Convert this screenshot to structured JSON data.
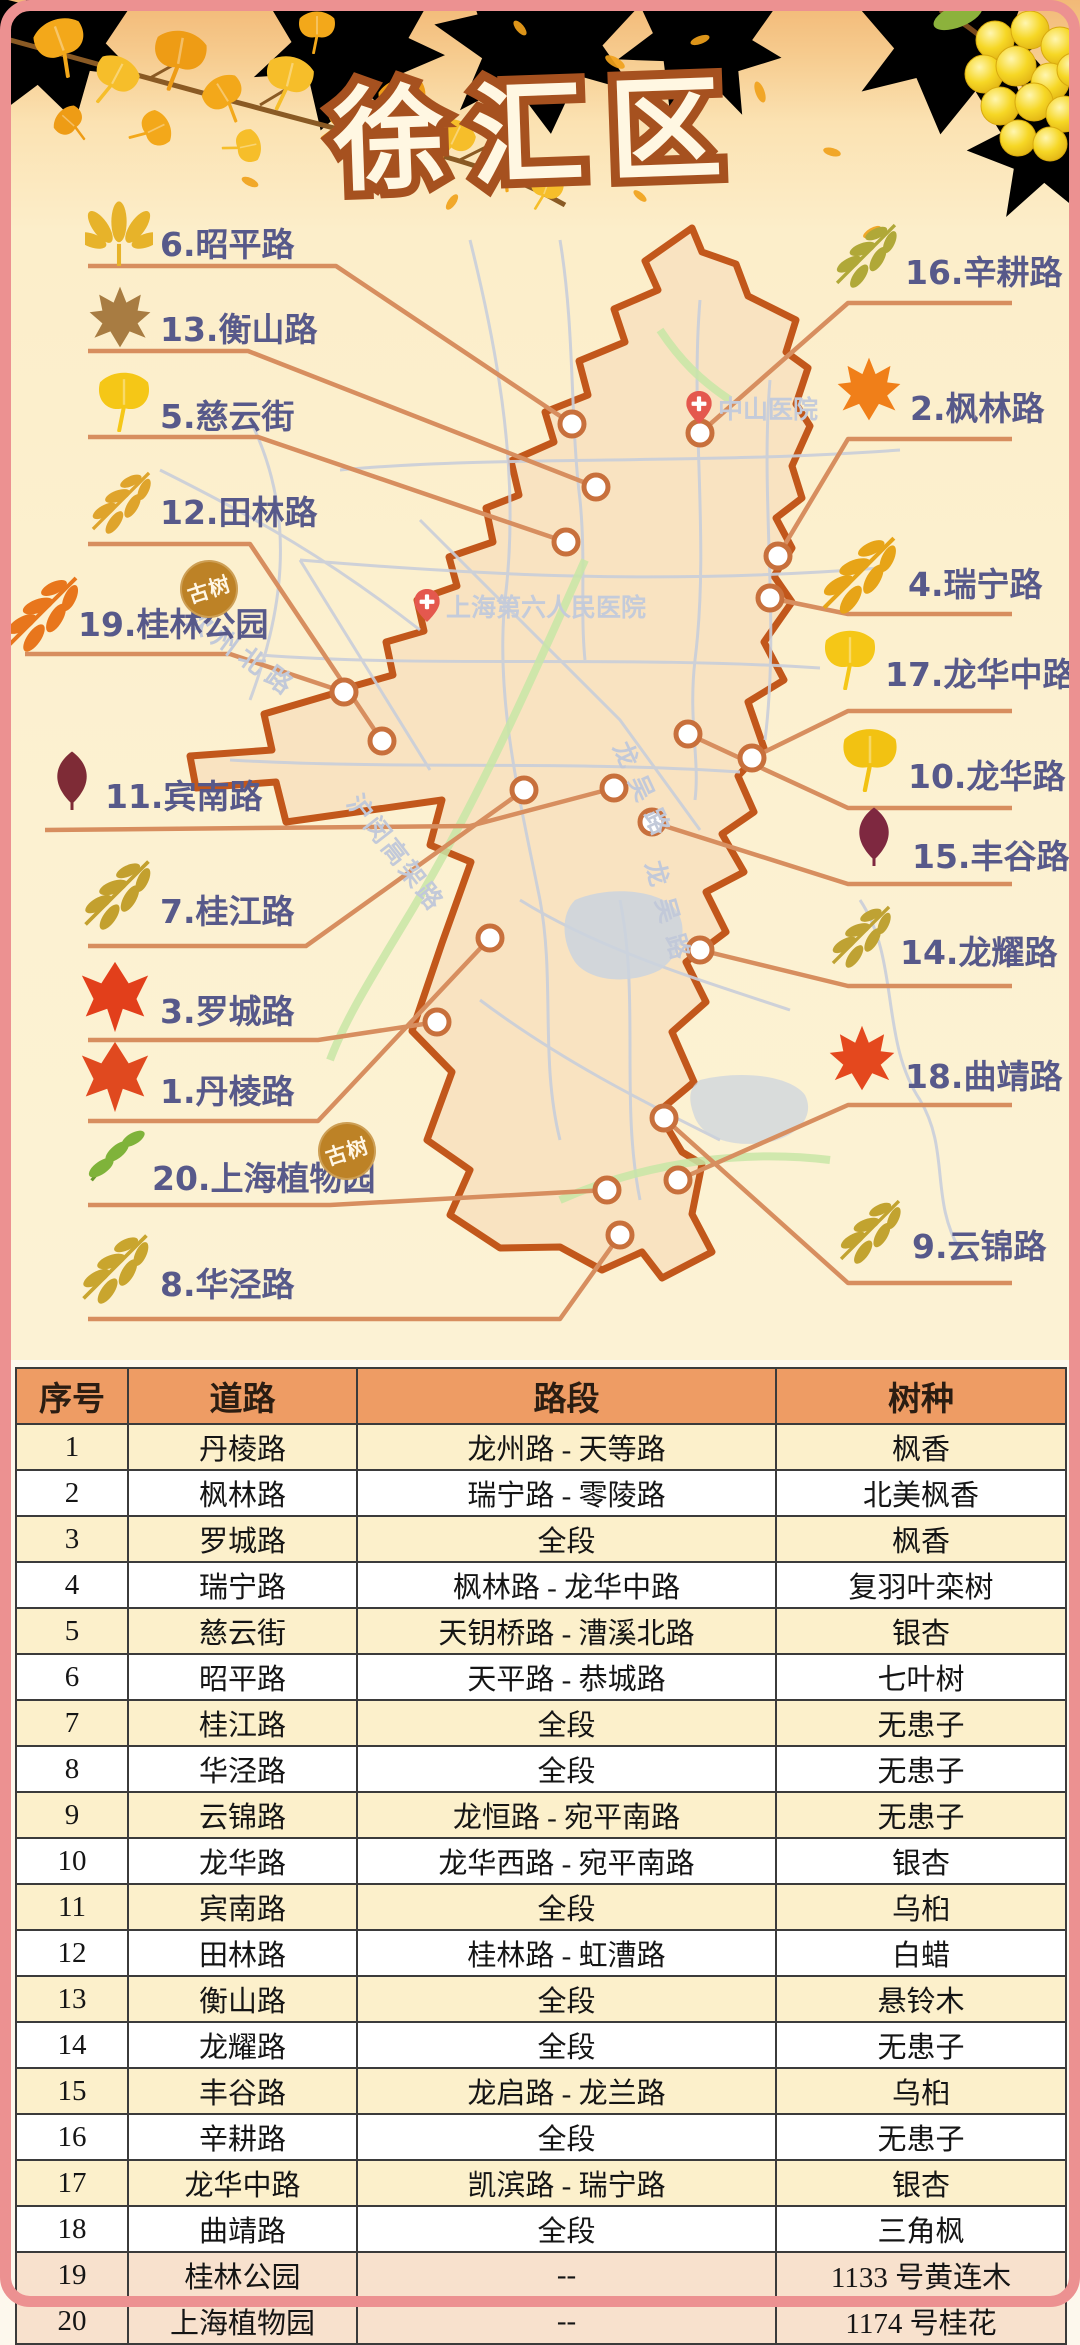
{
  "title": "徐汇区",
  "badge": "古树",
  "map": {
    "hospitals": [
      {
        "name": "中山医院"
      },
      {
        "name": "上海第六人民医院"
      }
    ],
    "road_names": [
      "钦州北路",
      "龙吴路",
      "龙吴路",
      "沪闵高架路"
    ],
    "labels": [
      {
        "id": 6,
        "text": "6.昭平路",
        "leaf": "palmate",
        "leaf_color": "#E7B32A"
      },
      {
        "id": 13,
        "text": "13.衡山路",
        "leaf": "maple5",
        "leaf_color": "#A87C42"
      },
      {
        "id": 5,
        "text": "5.慈云街",
        "leaf": "ginkgo",
        "leaf_color": "#F5C717"
      },
      {
        "id": 12,
        "text": "12.田林路",
        "leaf": "compound",
        "leaf_color": "#DFA42C"
      },
      {
        "id": 19,
        "text": "19.桂林公园",
        "leaf": "compound",
        "leaf_color": "#E8761C"
      },
      {
        "id": 11,
        "text": "11.宾南路",
        "leaf": "simple",
        "leaf_color": "#7E2B36"
      },
      {
        "id": 7,
        "text": "7.桂江路",
        "leaf": "compound",
        "leaf_color": "#C3A02E"
      },
      {
        "id": 3,
        "text": "3.罗城路",
        "leaf": "maple3",
        "leaf_color": "#E23F1B"
      },
      {
        "id": 1,
        "text": "1.丹棱路",
        "leaf": "maple3",
        "leaf_color": "#E0491F"
      },
      {
        "id": 20,
        "text": "20.上海植物园",
        "leaf": "sprig",
        "leaf_color": "#7FB33A"
      },
      {
        "id": 8,
        "text": "8.华泾路",
        "leaf": "compound",
        "leaf_color": "#C9A52E"
      },
      {
        "id": 16,
        "text": "16.辛耕路",
        "leaf": "compound",
        "leaf_color": "#B0A838"
      },
      {
        "id": 2,
        "text": "2.枫林路",
        "leaf": "maple5",
        "leaf_color": "#F07F19"
      },
      {
        "id": 4,
        "text": "4.瑞宁路",
        "leaf": "compound",
        "leaf_color": "#E7A417"
      },
      {
        "id": 17,
        "text": "17.龙华中路",
        "leaf": "ginkgo",
        "leaf_color": "#F5C717"
      },
      {
        "id": 10,
        "text": "10.龙华路",
        "leaf": "ginkgo",
        "leaf_color": "#F2C212"
      },
      {
        "id": 15,
        "text": "15.丰谷路",
        "leaf": "simple",
        "leaf_color": "#7E2840"
      },
      {
        "id": 14,
        "text": "14.龙耀路",
        "leaf": "compound",
        "leaf_color": "#BFA233"
      },
      {
        "id": 18,
        "text": "18.曲靖路",
        "leaf": "maple5",
        "leaf_color": "#E4481E"
      },
      {
        "id": 9,
        "text": "9.云锦路",
        "leaf": "compound",
        "leaf_color": "#C2A32F"
      }
    ]
  },
  "table": {
    "headers": [
      "序号",
      "道路",
      "路段",
      "树种"
    ],
    "rows": [
      [
        "1",
        "丹棱路",
        "龙州路 - 天等路",
        "枫香"
      ],
      [
        "2",
        "枫林路",
        "瑞宁路 - 零陵路",
        "北美枫香"
      ],
      [
        "3",
        "罗城路",
        "全段",
        "枫香"
      ],
      [
        "4",
        "瑞宁路",
        "枫林路 - 龙华中路",
        "复羽叶栾树"
      ],
      [
        "5",
        "慈云街",
        "天钥桥路 - 漕溪北路",
        "银杏"
      ],
      [
        "6",
        "昭平路",
        "天平路 - 恭城路",
        "七叶树"
      ],
      [
        "7",
        "桂江路",
        "全段",
        "无患子"
      ],
      [
        "8",
        "华泾路",
        "全段",
        "无患子"
      ],
      [
        "9",
        "云锦路",
        "龙恒路 - 宛平南路",
        "无患子"
      ],
      [
        "10",
        "龙华路",
        "龙华西路 - 宛平南路",
        "银杏"
      ],
      [
        "11",
        "宾南路",
        "全段",
        "乌桕"
      ],
      [
        "12",
        "田林路",
        "桂林路 - 虹漕路",
        "白蜡"
      ],
      [
        "13",
        "衡山路",
        "全段",
        "悬铃木"
      ],
      [
        "14",
        "龙耀路",
        "全段",
        "无患子"
      ],
      [
        "15",
        "丰谷路",
        "龙启路 - 龙兰路",
        "乌桕"
      ],
      [
        "16",
        "辛耕路",
        "全段",
        "无患子"
      ],
      [
        "17",
        "龙华中路",
        "凯滨路 - 瑞宁路",
        "银杏"
      ],
      [
        "18",
        "曲靖路",
        "全段",
        "三角枫"
      ],
      [
        "19",
        "桂林公园",
        "--",
        "1133 号黄连木"
      ],
      [
        "20",
        "上海植物园",
        "--",
        "1174 号桂花"
      ]
    ]
  },
  "colors": {
    "frame": "#EC9191",
    "title_fill": "#FFF7E2",
    "title_outline": "#A6511F",
    "label_text": "#57598A",
    "connector": "#D78E5F",
    "boundary": "#C2571B",
    "district_fill": "#F9E3C1",
    "panel_bg": "#FCF0CD",
    "header_bg": "#EE9C64",
    "row_alt": "#FCF0CB",
    "row_peach": "#F8E1CD",
    "hospital": "#E4584E",
    "map_road": "#C9CEDA",
    "map_green": "#C8E6A6",
    "badge_bg": "#BD8226"
  }
}
